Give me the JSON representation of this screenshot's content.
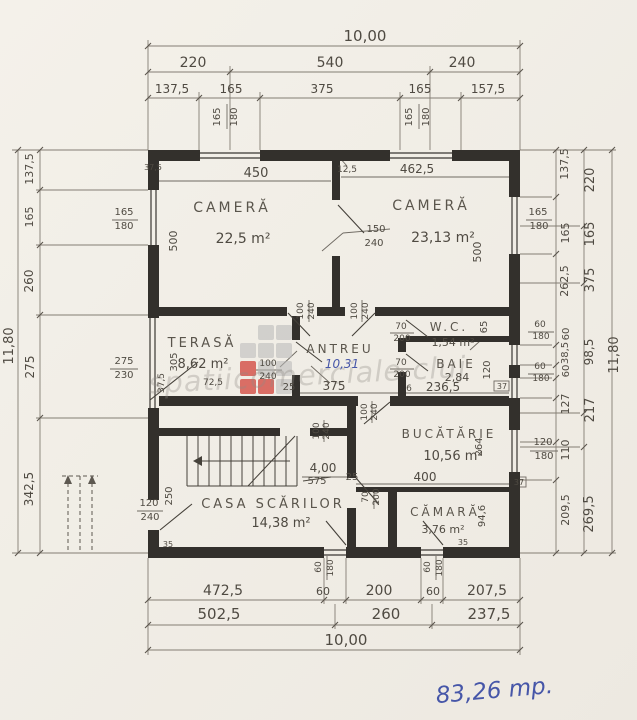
{
  "annotations": {
    "total_area": "83,26 mp.",
    "antreu_area_blue": "10,31"
  },
  "watermark": {
    "text": "spatiicomerciale cluj"
  },
  "rooms": [
    {
      "name": "CAMERĂ",
      "area": "22,5 m²"
    },
    {
      "name": "CAMERĂ",
      "area": "23,13 m²"
    },
    {
      "name": "W.C.",
      "area": "1,54 m²"
    },
    {
      "name": "BAIE",
      "area": "2,84"
    },
    {
      "name": "ANTREU",
      "area": "10,31"
    },
    {
      "name": "TERASĂ",
      "area": "8,62 m²"
    },
    {
      "name": "BUCĂTĂRIE",
      "area": "10,56 m²"
    },
    {
      "name": "CĂMARĂ",
      "area": "3,76 m²"
    },
    {
      "name": "CASA SCĂRILOR",
      "area": "14,38 m²"
    }
  ],
  "dimension_chains": {
    "top": {
      "overall": "10,00",
      "row2": [
        "220",
        "540",
        "240"
      ],
      "row3": [
        "137,5",
        "165",
        "375",
        "165",
        "157,5"
      ]
    },
    "bottom": {
      "row1": [
        "472,5",
        "60",
        "200",
        "60",
        "207,5"
      ],
      "row2": [
        "502,5",
        "260",
        "237,5"
      ],
      "overall": "10,00"
    },
    "left": {
      "overall": "11,80",
      "segments": [
        "137,5",
        "165",
        "260",
        "275",
        "342,5"
      ]
    },
    "right": {
      "overall": "11,80",
      "inner": [
        "137,5",
        "165",
        "262,5",
        "60",
        "38,5",
        "60",
        "127",
        "110",
        "209,5"
      ],
      "outer": [
        "220",
        "165",
        "375",
        "98,5",
        "217",
        "269,5"
      ]
    }
  },
  "labels": [
    {
      "t": "10,00",
      "x": 365,
      "y": 41,
      "s": 15
    },
    {
      "t": "220",
      "x": 193,
      "y": 67,
      "s": 14
    },
    {
      "t": "540",
      "x": 330,
      "y": 67,
      "s": 14
    },
    {
      "t": "240",
      "x": 462,
      "y": 67,
      "s": 14
    },
    {
      "t": "137,5",
      "x": 172,
      "y": 93,
      "s": 12
    },
    {
      "t": "165",
      "x": 231,
      "y": 93,
      "s": 12
    },
    {
      "t": "375",
      "x": 322,
      "y": 93,
      "s": 12
    },
    {
      "t": "165",
      "x": 420,
      "y": 93,
      "s": 12
    },
    {
      "t": "157,5",
      "x": 488,
      "y": 93,
      "s": 12
    },
    {
      "t": "165",
      "x": 220,
      "y": 117,
      "r": -90,
      "s": 10
    },
    {
      "t": "180",
      "x": 237,
      "y": 117,
      "r": -90,
      "s": 10
    },
    {
      "t": "165",
      "x": 412,
      "y": 117,
      "r": -90,
      "s": 10
    },
    {
      "t": "180",
      "x": 429,
      "y": 117,
      "r": -90,
      "s": 10
    },
    {
      "t": "450",
      "x": 256,
      "y": 177,
      "s": 13
    },
    {
      "t": "12,5",
      "x": 347,
      "y": 172,
      "s": 9
    },
    {
      "t": "462,5",
      "x": 417,
      "y": 173,
      "s": 12
    },
    {
      "t": "37,5",
      "x": 153,
      "y": 170,
      "s": 8
    },
    {
      "t": "150",
      "x": 376,
      "y": 232,
      "s": 10
    },
    {
      "t": "240",
      "x": 374,
      "y": 246,
      "s": 10
    },
    {
      "t": "500",
      "x": 177,
      "y": 241,
      "r": -90,
      "s": 11
    },
    {
      "t": "500",
      "x": 481,
      "y": 252,
      "r": -90,
      "s": 11
    },
    {
      "t": "165",
      "x": 124,
      "y": 215,
      "s": 10
    },
    {
      "t": "180",
      "x": 124,
      "y": 229,
      "s": 10
    },
    {
      "t": "165",
      "x": 538,
      "y": 215,
      "s": 10
    },
    {
      "t": "180",
      "x": 539,
      "y": 229,
      "s": 10
    },
    {
      "t": "137,5",
      "x": 33,
      "y": 169,
      "r": -90,
      "s": 11
    },
    {
      "t": "165",
      "x": 33,
      "y": 217,
      "r": -90,
      "s": 11
    },
    {
      "t": "260",
      "x": 33,
      "y": 281,
      "r": -90,
      "s": 12
    },
    {
      "t": "275",
      "x": 34,
      "y": 367,
      "r": -90,
      "s": 12
    },
    {
      "t": "342,5",
      "x": 33,
      "y": 489,
      "r": -90,
      "s": 12
    },
    {
      "t": "11,80",
      "x": 13,
      "y": 346,
      "r": -90,
      "s": 13
    },
    {
      "t": "275",
      "x": 124,
      "y": 364,
      "s": 10
    },
    {
      "t": "230",
      "x": 124,
      "y": 378,
      "s": 10
    },
    {
      "t": "137,5",
      "x": 568,
      "y": 164,
      "r": -90,
      "s": 11
    },
    {
      "t": "165",
      "x": 569,
      "y": 233,
      "r": -90,
      "s": 11
    },
    {
      "t": "262,5",
      "x": 568,
      "y": 281,
      "r": -90,
      "s": 11
    },
    {
      "t": "60",
      "x": 569,
      "y": 334,
      "r": -90,
      "s": 10
    },
    {
      "t": "38,5",
      "x": 568,
      "y": 353,
      "r": -90,
      "s": 10
    },
    {
      "t": "60",
      "x": 569,
      "y": 371,
      "r": -90,
      "s": 10
    },
    {
      "t": "127",
      "x": 569,
      "y": 404,
      "r": -90,
      "s": 11
    },
    {
      "t": "110",
      "x": 569,
      "y": 450,
      "r": -90,
      "s": 11
    },
    {
      "t": "209,5",
      "x": 569,
      "y": 510,
      "r": -90,
      "s": 11
    },
    {
      "t": "220",
      "x": 594,
      "y": 180,
      "r": -90,
      "s": 13
    },
    {
      "t": "165",
      "x": 594,
      "y": 234,
      "r": -90,
      "s": 13
    },
    {
      "t": "375",
      "x": 594,
      "y": 280,
      "r": -90,
      "s": 13
    },
    {
      "t": "98,5",
      "x": 593,
      "y": 352,
      "r": -90,
      "s": 12
    },
    {
      "t": "217",
      "x": 594,
      "y": 410,
      "r": -90,
      "s": 13
    },
    {
      "t": "269,5",
      "x": 593,
      "y": 514,
      "r": -90,
      "s": 13
    },
    {
      "t": "11,80",
      "x": 618,
      "y": 355,
      "r": -90,
      "s": 13
    },
    {
      "t": "60",
      "x": 540,
      "y": 327,
      "s": 9
    },
    {
      "t": "180",
      "x": 541,
      "y": 339,
      "s": 9
    },
    {
      "t": "60",
      "x": 540,
      "y": 369,
      "s": 9
    },
    {
      "t": "180",
      "x": 541,
      "y": 381,
      "s": 9
    },
    {
      "t": "120",
      "x": 543,
      "y": 445,
      "s": 10
    },
    {
      "t": "180",
      "x": 544,
      "y": 459,
      "s": 10
    },
    {
      "t": "65",
      "x": 487,
      "y": 327,
      "r": -90,
      "s": 10
    },
    {
      "t": "120",
      "x": 490,
      "y": 370,
      "r": -90,
      "s": 10
    },
    {
      "t": "70",
      "x": 401,
      "y": 329,
      "s": 9
    },
    {
      "t": "200",
      "x": 402,
      "y": 341,
      "s": 9
    },
    {
      "t": "70",
      "x": 401,
      "y": 365,
      "s": 9
    },
    {
      "t": "200",
      "x": 402,
      "y": 377,
      "s": 9
    },
    {
      "t": "236,5",
      "x": 443,
      "y": 391,
      "s": 12
    },
    {
      "t": "6",
      "x": 409,
      "y": 391,
      "s": 9
    },
    {
      "t": "37",
      "x": 502,
      "y": 389,
      "s": 8
    },
    {
      "t": "100",
      "x": 303,
      "y": 311,
      "r": -90,
      "s": 9
    },
    {
      "t": "240",
      "x": 314,
      "y": 311,
      "r": -90,
      "s": 9
    },
    {
      "t": "100",
      "x": 357,
      "y": 311,
      "r": -90,
      "s": 9
    },
    {
      "t": "240",
      "x": 368,
      "y": 311,
      "r": -90,
      "s": 9
    },
    {
      "t": "100",
      "x": 268,
      "y": 366,
      "s": 9
    },
    {
      "t": "240",
      "x": 268,
      "y": 379,
      "s": 9
    },
    {
      "t": "375",
      "x": 334,
      "y": 390,
      "s": 12
    },
    {
      "t": "25",
      "x": 289,
      "y": 390,
      "s": 10
    },
    {
      "t": "305",
      "x": 177,
      "y": 362,
      "r": -90,
      "s": 10
    },
    {
      "t": "37,5",
      "x": 164,
      "y": 383,
      "r": -90,
      "s": 9
    },
    {
      "t": "72,5",
      "x": 213,
      "y": 385,
      "s": 9
    },
    {
      "t": "264",
      "x": 482,
      "y": 447,
      "r": -90,
      "s": 10
    },
    {
      "t": "400",
      "x": 425,
      "y": 481,
      "s": 12
    },
    {
      "t": "25",
      "x": 352,
      "y": 480,
      "s": 10
    },
    {
      "t": "37",
      "x": 519,
      "y": 485,
      "s": 8
    },
    {
      "t": "94,6",
      "x": 485,
      "y": 516,
      "r": -90,
      "s": 10
    },
    {
      "t": "35",
      "x": 463,
      "y": 545,
      "s": 8
    },
    {
      "t": "70",
      "x": 368,
      "y": 497,
      "r": -90,
      "s": 9
    },
    {
      "t": "200",
      "x": 379,
      "y": 497,
      "r": -90,
      "s": 9
    },
    {
      "t": "100",
      "x": 367,
      "y": 412,
      "r": -90,
      "s": 9
    },
    {
      "t": "240",
      "x": 377,
      "y": 412,
      "r": -90,
      "s": 9
    },
    {
      "t": "4,00",
      "x": 323,
      "y": 472,
      "s": 12
    },
    {
      "t": "575",
      "x": 317,
      "y": 484,
      "s": 10,
      "strike": true
    },
    {
      "t": "120",
      "x": 149,
      "y": 506,
      "s": 10
    },
    {
      "t": "240",
      "x": 150,
      "y": 520,
      "s": 10
    },
    {
      "t": "250",
      "x": 172,
      "y": 496,
      "r": -90,
      "s": 10
    },
    {
      "t": "100",
      "x": 319,
      "y": 431,
      "r": -90,
      "s": 9
    },
    {
      "t": "240",
      "x": 329,
      "y": 431,
      "r": -90,
      "s": 9
    },
    {
      "t": "35",
      "x": 168,
      "y": 547,
      "s": 8
    },
    {
      "t": "60",
      "x": 321,
      "y": 567,
      "r": -90,
      "s": 9
    },
    {
      "t": "180",
      "x": 333,
      "y": 568,
      "r": -90,
      "s": 9
    },
    {
      "t": "60",
      "x": 430,
      "y": 567,
      "r": -90,
      "s": 9
    },
    {
      "t": "180",
      "x": 442,
      "y": 568,
      "r": -90,
      "s": 9
    },
    {
      "t": "472,5",
      "x": 223,
      "y": 595,
      "s": 14
    },
    {
      "t": "60",
      "x": 323,
      "y": 595,
      "s": 11
    },
    {
      "t": "200",
      "x": 379,
      "y": 595,
      "s": 14
    },
    {
      "t": "60",
      "x": 433,
      "y": 595,
      "s": 11
    },
    {
      "t": "207,5",
      "x": 487,
      "y": 595,
      "s": 14
    },
    {
      "t": "502,5",
      "x": 219,
      "y": 619,
      "s": 15
    },
    {
      "t": "260",
      "x": 386,
      "y": 619,
      "s": 15
    },
    {
      "t": "237,5",
      "x": 489,
      "y": 619,
      "s": 15
    },
    {
      "t": "10,00",
      "x": 346,
      "y": 645,
      "s": 15
    }
  ]
}
